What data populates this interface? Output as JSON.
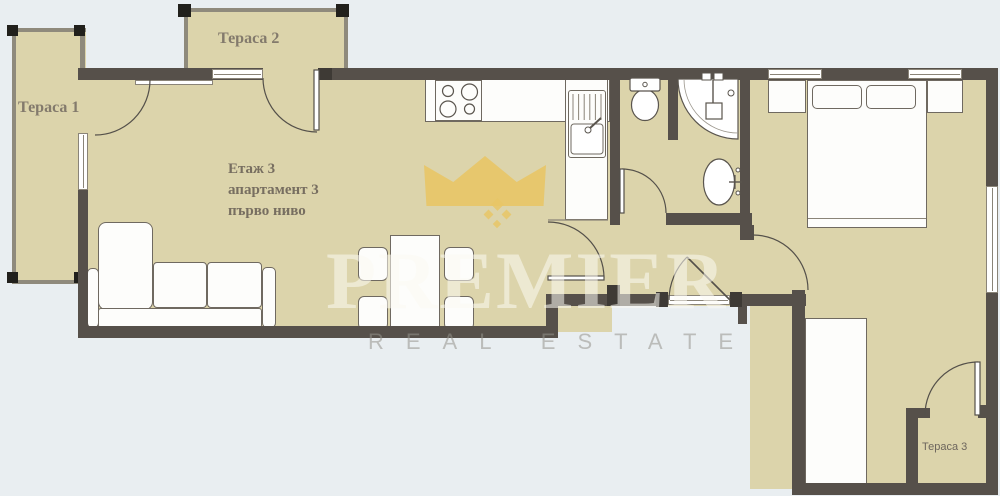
{
  "labels": {
    "terrace1": "Тераса 1",
    "terrace2": "Тераса 2",
    "terrace3": "Тераса 3"
  },
  "unit_info": {
    "line1": "Етаж 3",
    "line2": "апартамент 3",
    "line3": "първо ниво"
  },
  "watermark": {
    "brand": "PREMIER",
    "tagline": "REAL ESTATE"
  },
  "colors": {
    "bg": "#e9eef1",
    "floor": "#dcd4ab",
    "wall": "#56504a",
    "gold": "#e8c566",
    "label": "#776e60"
  }
}
